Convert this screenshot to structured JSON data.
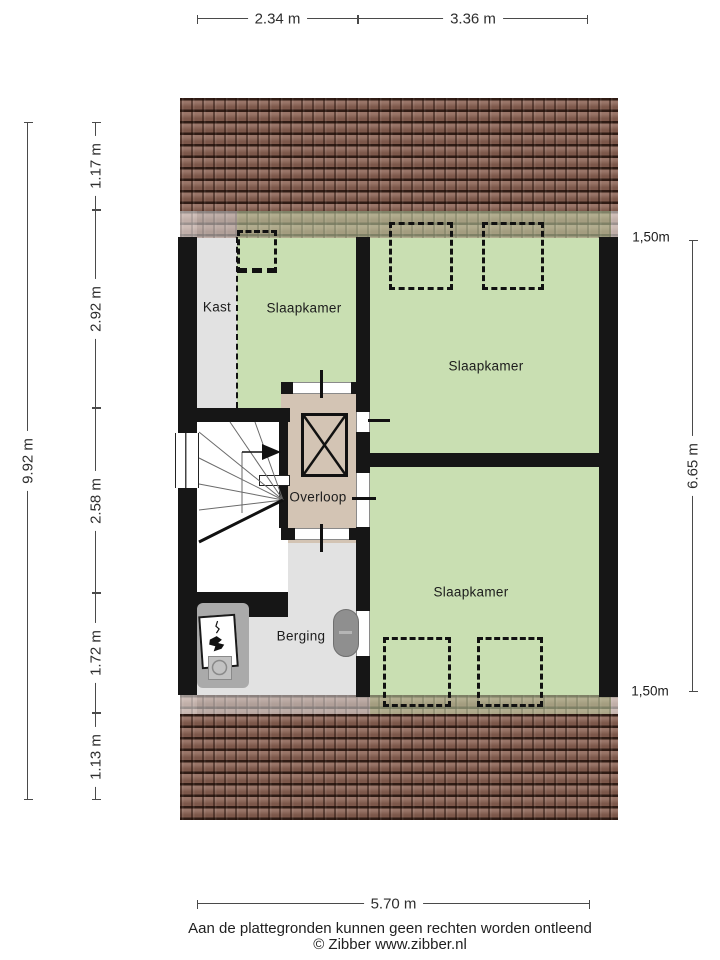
{
  "plan": {
    "rooms": {
      "kast": {
        "label": "Kast"
      },
      "slaapkamer1": {
        "label": "Slaapkamer"
      },
      "slaapkamer2": {
        "label": "Slaapkamer"
      },
      "slaapkamer3": {
        "label": "Slaapkamer"
      },
      "overloop": {
        "label": "Overloop"
      },
      "berging": {
        "label": "Berging"
      }
    }
  },
  "dimensions": {
    "top": [
      "2.34 m",
      "3.36 m"
    ],
    "left_total": "9.92 m",
    "left_segments": [
      "1.17 m",
      "2.92 m",
      "2.58 m",
      "1.72 m",
      "1.13 m"
    ],
    "right_total": "6.65 m",
    "right_clearance_top": "1,50m",
    "right_clearance_bottom": "1,50m",
    "bottom": "5.70 m"
  },
  "footer": {
    "disclaimer": "Aan de plattegronden kunnen geen rechten worden ontleend",
    "copyright": "© Zibber www.zibber.nl"
  },
  "colors": {
    "floor_green": "#c9dfb2",
    "floor_gray": "#e2e2e2",
    "floor_beige": "#d3c4b4",
    "wall": "#161616",
    "roof": "#8a6152"
  }
}
